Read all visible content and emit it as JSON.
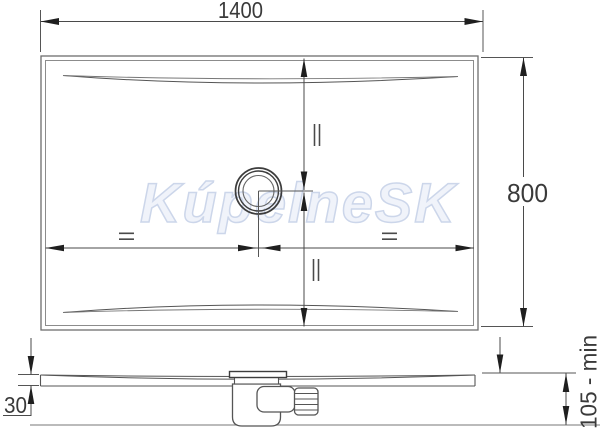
{
  "watermark": {
    "text": "KúpelneSK"
  },
  "plan_view": {
    "width_dim_label": "1400",
    "height_dim_label": "800",
    "equal_mark_left": "=",
    "equal_mark_right": "=",
    "equal_mark_top": "||",
    "equal_mark_bottom": "||"
  },
  "side_view": {
    "edge_thickness_label": "30",
    "min_install_height_label": "105 - min"
  },
  "colors": {
    "outline": "#6e6e6e",
    "inner_outline": "#8c8c8c",
    "contour": "#555555",
    "dim_line": "#4a4a4a",
    "arrow": "#1f1f1f",
    "text": "#3a3a3a",
    "watermark": "#ccd6ea"
  }
}
